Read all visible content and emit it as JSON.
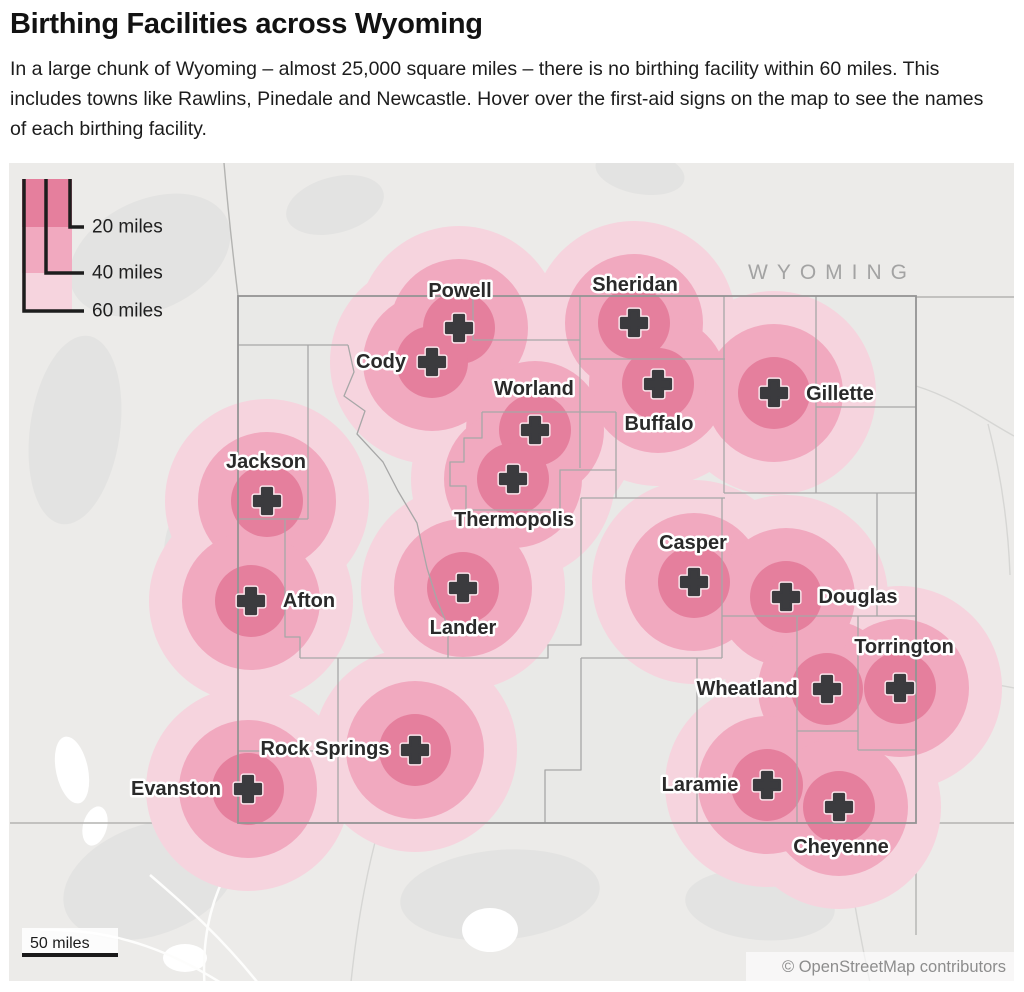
{
  "header": {
    "title": "Birthing Facilities across Wyoming",
    "subtitle": "In a large chunk of Wyoming – almost 25,000 square miles – there is no birthing facility within 60 miles. This includes towns like Rawlins, Pinedale and Newcastle. Hover over the first-aid signs on the map to see the names of each birthing facility."
  },
  "legend": {
    "items": [
      {
        "label": "20 miles"
      },
      {
        "label": "40 miles"
      },
      {
        "label": "60 miles"
      }
    ]
  },
  "map": {
    "state_label": "WYOMING",
    "scale_label": "50 miles",
    "attribution": "© OpenStreetMap contributors",
    "rings_miles": [
      20,
      40,
      60
    ],
    "ring_radii_px": [
      36,
      69,
      102
    ],
    "ring_colors": [
      "#e57f9d",
      "#f1a9bf",
      "#f6d4de"
    ],
    "marker_color": "#3b3b3e",
    "facilities": [
      {
        "name": "Powell",
        "x": 459,
        "y": 328,
        "lx": 460,
        "ly": 291
      },
      {
        "name": "Cody",
        "x": 432,
        "y": 362,
        "lx": 381,
        "ly": 362
      },
      {
        "name": "Sheridan",
        "x": 634,
        "y": 323,
        "lx": 635,
        "ly": 285
      },
      {
        "name": "Buffalo",
        "x": 658,
        "y": 384,
        "lx": 659,
        "ly": 424
      },
      {
        "name": "Gillette",
        "x": 774,
        "y": 393,
        "lx": 840,
        "ly": 394
      },
      {
        "name": "Worland",
        "x": 535,
        "y": 430,
        "lx": 534,
        "ly": 389
      },
      {
        "name": "Thermopolis",
        "x": 513,
        "y": 479,
        "lx": 514,
        "ly": 520
      },
      {
        "name": "Jackson",
        "x": 267,
        "y": 501,
        "lx": 266,
        "ly": 462
      },
      {
        "name": "Afton",
        "x": 251,
        "y": 601,
        "lx": 309,
        "ly": 601
      },
      {
        "name": "Lander",
        "x": 463,
        "y": 588,
        "lx": 463,
        "ly": 628
      },
      {
        "name": "Casper",
        "x": 694,
        "y": 582,
        "lx": 693,
        "ly": 543
      },
      {
        "name": "Douglas",
        "x": 786,
        "y": 597,
        "lx": 858,
        "ly": 597
      },
      {
        "name": "Wheatland",
        "x": 827,
        "y": 689,
        "lx": 747,
        "ly": 689
      },
      {
        "name": "Torrington",
        "x": 900,
        "y": 688,
        "lx": 904,
        "ly": 647
      },
      {
        "name": "Rock Springs",
        "x": 415,
        "y": 750,
        "lx": 325,
        "ly": 749
      },
      {
        "name": "Evanston",
        "x": 248,
        "y": 789,
        "lx": 176,
        "ly": 789
      },
      {
        "name": "Laramie",
        "x": 767,
        "y": 785,
        "lx": 700,
        "ly": 785
      },
      {
        "name": "Cheyenne",
        "x": 839,
        "y": 807,
        "lx": 841,
        "ly": 847
      }
    ]
  }
}
